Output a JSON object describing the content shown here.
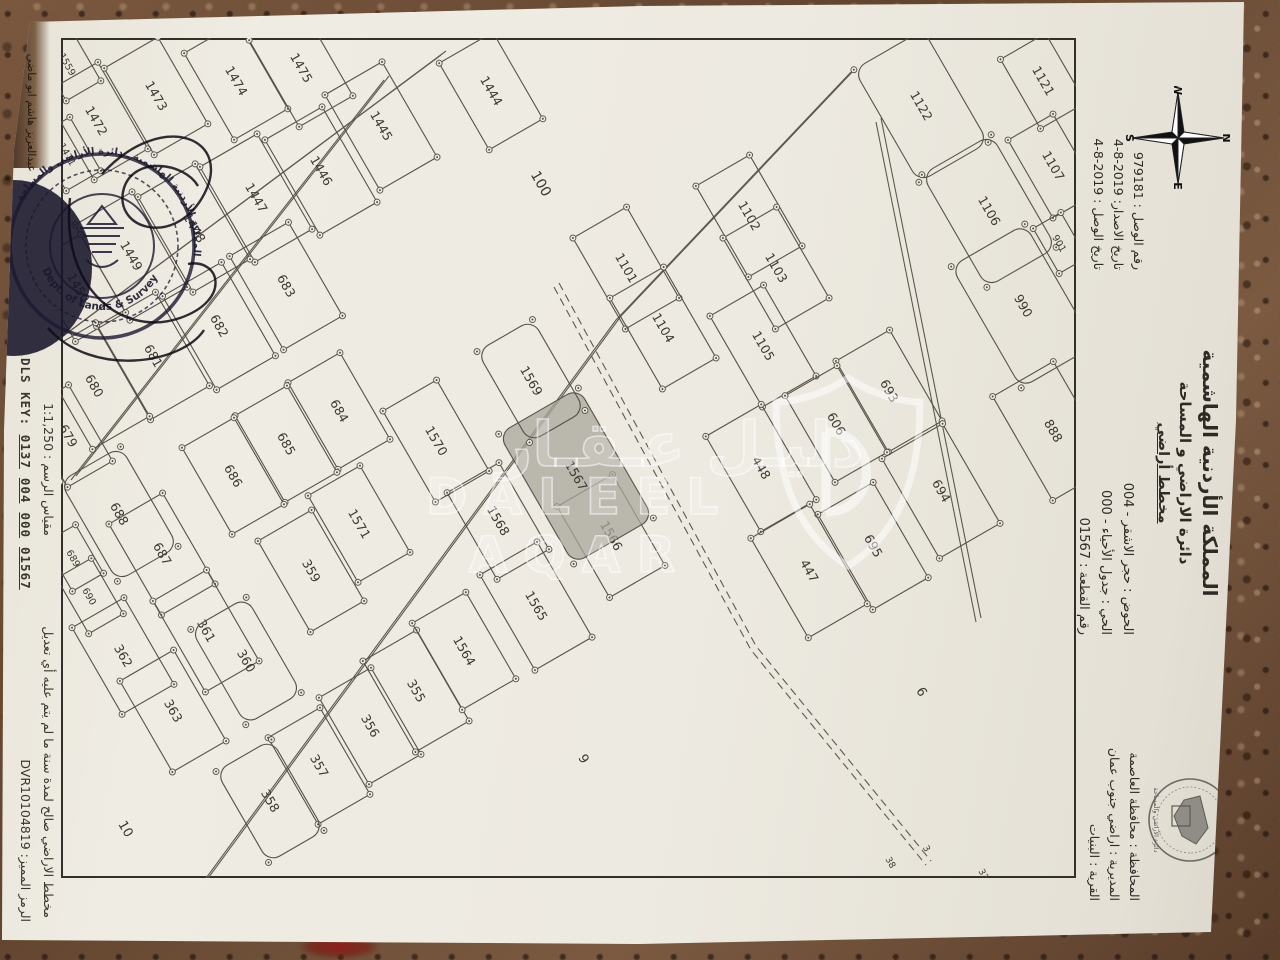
{
  "header": {
    "kingdom": "المملكة الأردنية الهاشمية",
    "department": "دائرة الاراضي و المساحة",
    "plan_type": "مخطط أراضي"
  },
  "fields": {
    "rows": [
      "الحوض : حجر الاشقر - 004",
      "الحي : جدول الأحياء - 000",
      "رقم القطعة : 01567"
    ]
  },
  "receipt": {
    "rows": [
      "رقم الوصل : 979181",
      "تاريخ الاصدار: 2019-8-4",
      "تاريخ الوصل : 2019-8-4"
    ]
  },
  "province": {
    "rows": [
      "المحافظة : محافظة العاصمة",
      "المديرية : اراضي جنوب عمان",
      "القرية : البنيات"
    ]
  },
  "footer": {
    "validity": "مخطط الاراضي صالح لمدة سنة ما لم يتم عليه أي تعديل",
    "scale": "مقياس الرسم : 1:1,250",
    "code": "الرمز المميز: DVR10104819",
    "dls_label": "DLS KEY:",
    "dls_parts": [
      "0137",
      "004",
      "000",
      "01567"
    ],
    "surveyor": "عبدالعزيز هاشم ابو ماضي"
  },
  "compass": {
    "n": "N",
    "s": "S",
    "e": "E",
    "w": "W"
  },
  "watermark": {
    "arabic": "دليـل عـقـار",
    "latin": "DALEEL AQAR"
  },
  "stamp": {
    "ring_ar": "المملكة الأردنية الهاشمية ـ دائرة الأراضي والمساحة",
    "ring_en": "Dept. of Lands & Survey"
  },
  "logo": {
    "caption": "دائرة الأراضي والمساحة"
  },
  "map": {
    "frame": {
      "w": 840,
      "h": 1015
    },
    "highlight_parcel": "1567",
    "roads": [
      {
        "pts": [
          [
            30,
            220
          ],
          [
            278,
            455
          ],
          [
            843,
            870
          ]
        ],
        "dashed": false
      },
      {
        "pts": [
          [
            38,
            687
          ],
          [
            438,
            1000
          ]
        ],
        "dashed": false
      },
      {
        "pts": [
          [
            13,
            630
          ],
          [
            298,
            1013
          ]
        ],
        "dashed": false
      },
      {
        "pts": [
          [
            80,
            195
          ],
          [
            580,
            95
          ]
        ],
        "dashed": false
      },
      {
        "pts": [
          [
            245,
            517
          ],
          [
            608,
            320
          ],
          [
            823,
            145
          ]
        ],
        "dashed": true
      }
    ],
    "parcels": [
      {
        "n": "1559",
        "x": 26,
        "y": 1008,
        "w": 62,
        "h": 40
      },
      {
        "n": "1471",
        "x": 116,
        "y": 1008,
        "w": 62,
        "h": 40
      },
      {
        "n": "1472",
        "x": 83,
        "y": 980,
        "w": 100,
        "h": 62
      },
      {
        "n": "1473",
        "x": 58,
        "y": 920,
        "w": 100,
        "h": 62
      },
      {
        "n": "1474",
        "x": 43,
        "y": 840,
        "w": 100,
        "h": 62
      },
      {
        "n": "1475",
        "x": 30,
        "y": 775,
        "w": 100,
        "h": 62
      },
      {
        "n": "1444",
        "x": 53,
        "y": 585,
        "w": 100,
        "h": 62
      },
      {
        "n": "1445",
        "x": 88,
        "y": 695,
        "w": 110,
        "h": 66
      },
      {
        "n": "1446",
        "x": 133,
        "y": 755,
        "w": 110,
        "h": 66
      },
      {
        "n": "1447",
        "x": 160,
        "y": 820,
        "w": 110,
        "h": 66
      },
      {
        "n": "1448",
        "x": 190,
        "y": 882,
        "w": 110,
        "h": 66
      },
      {
        "n": "1449",
        "x": 218,
        "y": 945,
        "w": 110,
        "h": 66
      },
      {
        "n": "1450",
        "x": 250,
        "y": 998,
        "w": 90,
        "h": 58
      },
      {
        "n": "683",
        "x": 248,
        "y": 790,
        "w": 108,
        "h": 68
      },
      {
        "n": "682",
        "x": 288,
        "y": 857,
        "w": 108,
        "h": 68
      },
      {
        "n": "681",
        "x": 318,
        "y": 923,
        "w": 108,
        "h": 68
      },
      {
        "n": "680",
        "x": 348,
        "y": 982,
        "w": 108,
        "h": 66
      },
      {
        "n": "679",
        "x": 398,
        "y": 1008,
        "w": 88,
        "h": 52
      },
      {
        "n": "684",
        "x": 373,
        "y": 737,
        "w": 100,
        "h": 60
      },
      {
        "n": "685",
        "x": 406,
        "y": 790,
        "w": 100,
        "h": 60
      },
      {
        "n": "686",
        "x": 438,
        "y": 843,
        "w": 100,
        "h": 60
      },
      {
        "n": "1571",
        "x": 486,
        "y": 717,
        "w": 100,
        "h": 60
      },
      {
        "n": "359",
        "x": 533,
        "y": 765,
        "w": 105,
        "h": 62
      },
      {
        "n": "688",
        "x": 476,
        "y": 957,
        "w": 115,
        "h": 70,
        "r": true
      },
      {
        "n": "687",
        "x": 516,
        "y": 914,
        "w": 105,
        "h": 62
      },
      {
        "n": "689",
        "x": 520,
        "y": 1002,
        "w": 56,
        "h": 36
      },
      {
        "n": "690",
        "x": 558,
        "y": 986,
        "w": 64,
        "h": 40
      },
      {
        "n": "361",
        "x": 593,
        "y": 870,
        "w": 105,
        "h": 62
      },
      {
        "n": "362",
        "x": 618,
        "y": 953,
        "w": 100,
        "h": 60
      },
      {
        "n": "360",
        "x": 623,
        "y": 830,
        "w": 110,
        "h": 64,
        "r": true
      },
      {
        "n": "363",
        "x": 673,
        "y": 903,
        "w": 105,
        "h": 62
      },
      {
        "n": "355",
        "x": 653,
        "y": 660,
        "w": 105,
        "h": 62
      },
      {
        "n": "356",
        "x": 688,
        "y": 706,
        "w": 100,
        "h": 60
      },
      {
        "n": "357",
        "x": 728,
        "y": 757,
        "w": 100,
        "h": 60
      },
      {
        "n": "358",
        "x": 763,
        "y": 806,
        "w": 105,
        "h": 64,
        "r": true
      },
      {
        "n": "1564",
        "x": 613,
        "y": 612,
        "w": 100,
        "h": 62
      },
      {
        "n": "1565",
        "x": 568,
        "y": 540,
        "w": 110,
        "h": 66
      },
      {
        "n": "1566",
        "x": 498,
        "y": 465,
        "w": 105,
        "h": 64
      },
      {
        "n": "1568",
        "x": 483,
        "y": 578,
        "w": 100,
        "h": 60
      },
      {
        "n": "1567",
        "x": 438,
        "y": 500,
        "w": 150,
        "h": 92,
        "r": true,
        "s": true
      },
      {
        "n": "1569",
        "x": 343,
        "y": 545,
        "w": 105,
        "h": 64,
        "r": true
      },
      {
        "n": "1570",
        "x": 403,
        "y": 640,
        "w": 105,
        "h": 62
      },
      {
        "n": "1101",
        "x": 230,
        "y": 450,
        "w": 105,
        "h": 62
      },
      {
        "n": "1104",
        "x": 290,
        "y": 413,
        "w": 105,
        "h": 62
      },
      {
        "n": "1102",
        "x": 178,
        "y": 327,
        "w": 105,
        "h": 62
      },
      {
        "n": "1103",
        "x": 230,
        "y": 300,
        "w": 105,
        "h": 62
      },
      {
        "n": "1105",
        "x": 308,
        "y": 313,
        "w": 105,
        "h": 62
      },
      {
        "n": "693",
        "x": 353,
        "y": 187,
        "w": 105,
        "h": 62
      },
      {
        "n": "606",
        "x": 386,
        "y": 240,
        "w": 100,
        "h": 60
      },
      {
        "n": "694",
        "x": 453,
        "y": 135,
        "w": 115,
        "h": 70
      },
      {
        "n": "695",
        "x": 508,
        "y": 203,
        "w": 110,
        "h": 64
      },
      {
        "n": "448",
        "x": 430,
        "y": 315,
        "w": 110,
        "h": 64
      },
      {
        "n": "447",
        "x": 533,
        "y": 267,
        "w": 115,
        "h": 68
      },
      {
        "n": "888",
        "x": 393,
        "y": 23,
        "w": 120,
        "h": 70
      },
      {
        "n": "1122",
        "x": 68,
        "y": 155,
        "w": 130,
        "h": 80,
        "r": true
      },
      {
        "n": "1121",
        "x": 43,
        "y": 33,
        "w": 80,
        "h": 52
      },
      {
        "n": "1107",
        "x": 128,
        "y": 23,
        "w": 90,
        "h": 52
      },
      {
        "n": "1106",
        "x": 173,
        "y": 87,
        "w": 130,
        "h": 80,
        "r": true
      },
      {
        "n": "901",
        "x": 205,
        "y": 16,
        "w": 52,
        "h": 32
      },
      {
        "n": "990",
        "x": 268,
        "y": 53,
        "w": 140,
        "h": 85,
        "r": true
      }
    ],
    "tags": [
      {
        "n": "100",
        "x": 148,
        "y": 539,
        "f": 14
      },
      {
        "n": "6",
        "x": 656,
        "y": 158,
        "f": 13
      },
      {
        "n": "9",
        "x": 723,
        "y": 496,
        "f": 13
      },
      {
        "n": "10",
        "x": 793,
        "y": 954,
        "f": 13
      },
      {
        "n": "33",
        "x": 838,
        "y": 95,
        "f": 9
      },
      {
        "n": "34",
        "x": 852,
        "y": 130,
        "f": 9
      },
      {
        "n": "35",
        "x": 862,
        "y": 168,
        "f": 9
      },
      {
        "n": "3",
        "x": 812,
        "y": 152,
        "f": 9
      },
      {
        "n": "38",
        "x": 826,
        "y": 188,
        "f": 9
      }
    ]
  }
}
